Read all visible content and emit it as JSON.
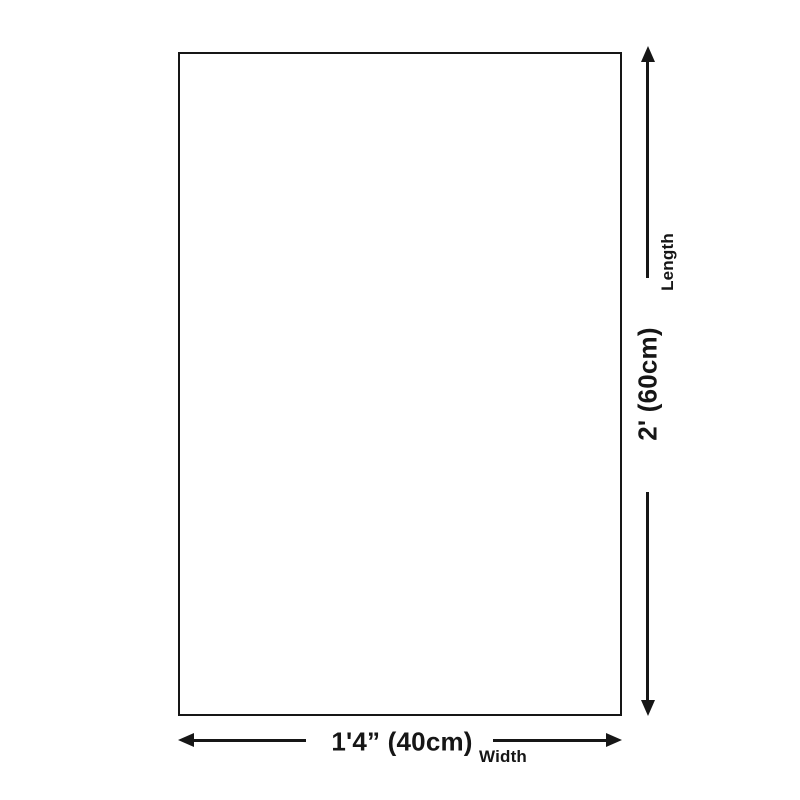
{
  "diagram": {
    "type": "product-dimension-diagram",
    "shape": "rectangle",
    "length": {
      "label": "Length",
      "value": "2' (60cm)"
    },
    "width": {
      "label": "Width",
      "value": "1'4” (40cm)"
    }
  },
  "colors": {
    "line": "#161616",
    "background": "#ffffff",
    "text": "#161616"
  }
}
